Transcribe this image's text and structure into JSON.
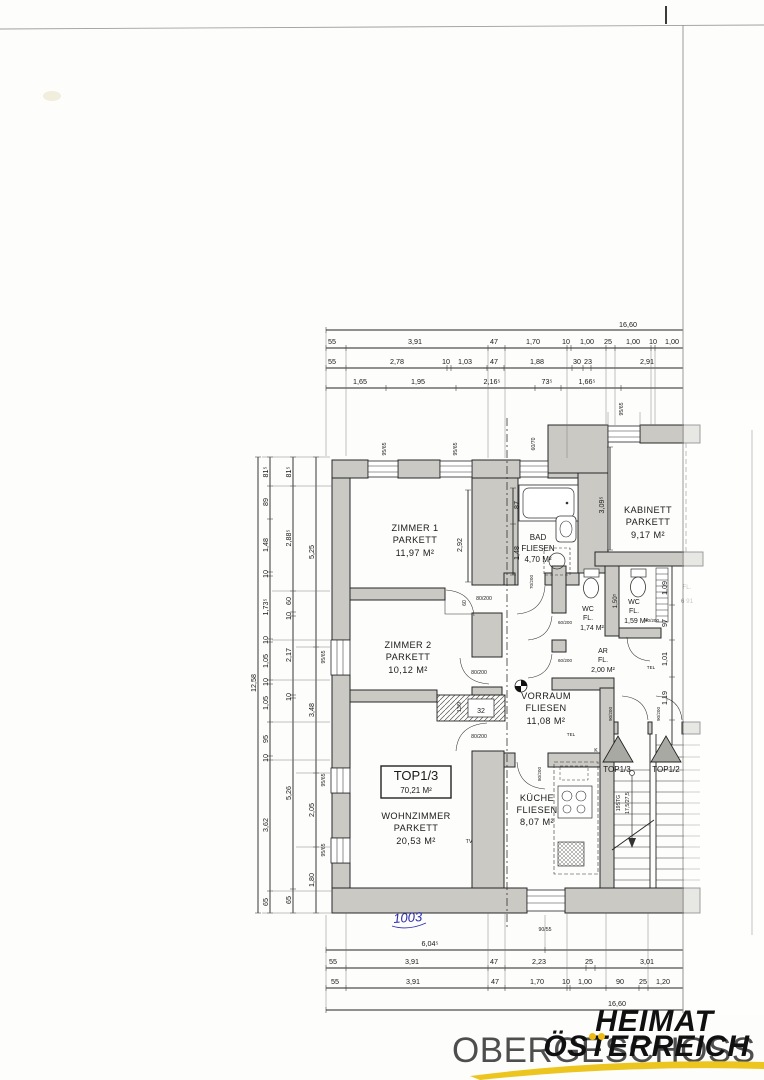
{
  "title": {
    "text": "OBERGESCHOSS"
  },
  "logo": {
    "line1": "HEIMAT",
    "line2": "ÖSTERREICH",
    "accent": "#eebc10"
  },
  "note": {
    "handwritten": "1003"
  },
  "unit": {
    "label": "TOP1/3",
    "area": "70,21 M²"
  },
  "rooms": {
    "zimmer1": {
      "name": "ZIMMER 1",
      "finish": "PARKETT",
      "area": "11,97 M²"
    },
    "zimmer2": {
      "name": "ZIMMER 2",
      "finish": "PARKETT",
      "area": "10,12 M²"
    },
    "wohnzimmer": {
      "name": "WOHNZIMMER",
      "finish": "PARKETT",
      "area": "20,53 M²"
    },
    "bad": {
      "name": "BAD",
      "finish": "FLIESEN",
      "area": "4,70 M²"
    },
    "kabinett": {
      "name": "KABINETT",
      "finish": "PARKETT",
      "area": "9,17 M²"
    },
    "wc1": {
      "name": "WC",
      "finish": "FL.",
      "area": "1,74 M²"
    },
    "wc2": {
      "name": "WC",
      "finish": "FL.",
      "area": "1,59 M²"
    },
    "ar": {
      "name": "AR",
      "finish": "FL.",
      "area": "2,00 M²"
    },
    "vorraum": {
      "name": "VORRAUM",
      "finish": "FLIESEN",
      "area": "11,08 M²"
    },
    "kueche": {
      "name": "KÜCHE",
      "finish": "FLIESEN",
      "area": "8,07 M²"
    }
  },
  "entrances": {
    "left": "TOP1/3",
    "right": "TOP1/2"
  },
  "stairs": {
    "line1": "19STG",
    "line2": "17,5/27,5"
  },
  "labels": {
    "tel": "TEL",
    "tv": "TV",
    "k": "K",
    "chimney_size": "32",
    "chimney_dim": "13/9",
    "fragment1": "FL.",
    "fragment2": "6 91"
  },
  "doors": {
    "zimmer1": "80/200",
    "zimmer1_niche": "60",
    "zimmer2": "80/200",
    "wohnzimmer": "80/200",
    "bad": "70/200",
    "wc1": "60/200",
    "wc2": "60/200",
    "ar": "60/200",
    "kueche": "80/200",
    "entrance_left": "90/200",
    "entrance_right": "90/200"
  },
  "windows": {
    "top1": "95/65",
    "top2": "95/65",
    "bad": "60/70",
    "kabinett": "95/65",
    "left1": "95/65",
    "left2": "95/65",
    "left3": "95/65",
    "bottom": "90/55"
  },
  "dims": {
    "top": {
      "total": "16,60",
      "row1": [
        "55",
        "3,91",
        "47",
        "1,70",
        "10",
        "1,00",
        "25",
        "1,00",
        "10",
        "1,00"
      ],
      "row2": [
        "55",
        "2,78",
        "10",
        "1,03",
        "47",
        "1,88",
        "30",
        "23",
        "2,91"
      ],
      "row3": [
        "1,65",
        "1,95",
        "2,16⁵",
        "73⁵",
        "1,66⁵"
      ]
    },
    "bottom": {
      "row1": "6,04⁵",
      "row2": [
        "55",
        "3,91",
        "47",
        "2,23",
        "25",
        "3,01"
      ],
      "row3": [
        "55",
        "3,91",
        "47",
        "1,70",
        "10",
        "1,00",
        "90",
        "25",
        "1,20"
      ],
      "total": "16,60"
    },
    "left": {
      "total": "12,58",
      "col_a": [
        "81⁵",
        "89",
        "1,48",
        "10",
        "1,73⁵",
        "10",
        "1,05",
        "10",
        "1,05",
        "95",
        "10",
        "3,62",
        "65"
      ],
      "col_b": [
        "81⁵",
        "2,88⁵",
        "60",
        "10",
        "2,17",
        "10",
        "5,26",
        "65"
      ],
      "col_c": [
        "5,25",
        "3,48",
        "2,05",
        "1,80"
      ]
    },
    "right": [
      "1,09",
      "97",
      "1,01",
      "1,19"
    ],
    "inner": {
      "zimmer1_h": "2,92",
      "kabinett_h": "3,09⁵",
      "bad_a": "87",
      "bad_b": "1,48",
      "wc_h": "1,50⁵"
    }
  }
}
